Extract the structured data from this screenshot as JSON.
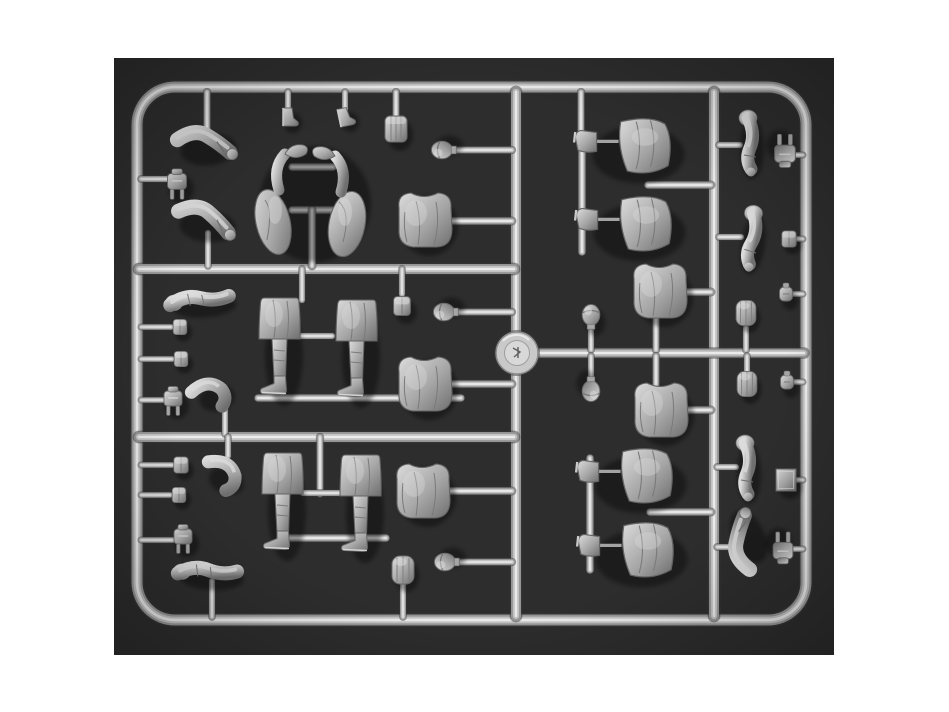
{
  "scene": {
    "type": "photograph",
    "subject": "plastic-model-kit-sprue-with-soldier-figure-parts",
    "canvas": {
      "width": 949,
      "height": 712
    },
    "photo": {
      "x": 114,
      "y": 58,
      "width": 720,
      "height": 597
    },
    "colors": {
      "page_bg": "#ffffff",
      "photo_bg": "#2d2d2d",
      "tube_dark": "#3a3a3a",
      "tube_base": "#959595",
      "tube_mid": "#c2c2c2",
      "tube_highlight": "#efefef",
      "part_base": "#a6a6a6",
      "part_light": "#dcdcdc",
      "part_shadow": "#6f6f6f",
      "part_outline": "#646464",
      "hub_fill": "#c9c9c9",
      "hub_inner": "#d8d8d8"
    }
  },
  "sprue": {
    "frame": {
      "x": 137,
      "y": 87,
      "width": 669,
      "height": 533,
      "radius": 38,
      "tube_width": 11
    },
    "hub": {
      "cx": 517,
      "cy": 353,
      "r": 21,
      "inner_r": 12.5
    },
    "runners": [
      [
        516,
        92,
        516,
        616,
        10
      ],
      [
        714,
        92,
        714,
        616,
        10
      ],
      [
        139,
        269,
        514,
        269,
        10
      ],
      [
        139,
        437,
        514,
        437,
        10
      ],
      [
        536,
        353,
        804,
        353,
        9
      ]
    ],
    "stubs": [
      [
        207,
        92,
        207,
        130,
        6.5
      ],
      [
        288,
        92,
        288,
        109,
        6
      ],
      [
        345,
        92,
        345,
        109,
        6
      ],
      [
        396,
        92,
        396,
        116,
        6.5
      ],
      [
        581,
        92,
        581,
        140,
        6.5
      ],
      [
        141,
        179,
        168,
        179,
        6
      ],
      [
        141,
        327,
        171,
        327,
        5.5
      ],
      [
        141,
        359,
        172,
        359,
        5.5
      ],
      [
        141,
        400,
        163,
        400,
        5.5
      ],
      [
        141,
        465,
        172,
        465,
        5.5
      ],
      [
        141,
        495,
        170,
        495,
        5.5
      ],
      [
        141,
        540,
        173,
        540,
        5.5
      ],
      [
        452,
        150,
        512,
        150,
        6.5
      ],
      [
        450,
        221,
        512,
        221,
        7
      ],
      [
        455,
        312,
        512,
        312,
        6.5
      ],
      [
        450,
        384,
        512,
        384,
        7
      ],
      [
        450,
        491,
        512,
        491,
        7
      ],
      [
        455,
        562,
        512,
        562,
        6.5
      ],
      [
        292,
        167,
        333,
        167,
        7
      ],
      [
        292,
        210,
        333,
        210,
        7
      ],
      [
        312,
        210,
        312,
        266,
        7
      ],
      [
        297,
        336,
        332,
        336,
        6
      ],
      [
        302,
        269,
        302,
        300,
        6
      ],
      [
        402,
        269,
        402,
        294,
        6
      ],
      [
        258,
        398,
        461,
        398,
        7
      ],
      [
        208,
        233,
        208,
        266,
        6
      ],
      [
        320,
        437,
        320,
        494,
        6.5
      ],
      [
        303,
        493,
        340,
        493,
        6
      ],
      [
        289,
        538,
        386,
        538,
        7
      ],
      [
        225,
        408,
        225,
        434,
        6
      ],
      [
        228,
        437,
        228,
        456,
        6
      ],
      [
        212,
        581,
        212,
        617,
        6
      ],
      [
        403,
        584,
        403,
        617,
        6
      ],
      [
        582,
        135,
        582,
        252,
        7
      ],
      [
        648,
        185,
        711,
        185,
        7
      ],
      [
        719,
        145,
        740,
        145,
        6
      ],
      [
        719,
        237,
        741,
        237,
        6
      ],
      [
        686,
        292,
        711,
        292,
        7
      ],
      [
        656,
        313,
        656,
        350,
        6.5
      ],
      [
        656,
        356,
        656,
        386,
        6.5
      ],
      [
        687,
        410,
        711,
        410,
        7
      ],
      [
        746,
        328,
        746,
        350,
        6
      ],
      [
        747,
        356,
        747,
        371,
        6
      ],
      [
        591,
        326,
        591,
        350,
        6
      ],
      [
        591,
        356,
        591,
        380,
        6
      ],
      [
        793,
        155,
        803,
        155,
        5.5
      ],
      [
        795,
        239,
        803,
        239,
        5.5
      ],
      [
        794,
        294,
        803,
        294,
        5.5
      ],
      [
        795,
        382,
        803,
        382,
        5.5
      ],
      [
        590,
        458,
        590,
        570,
        7
      ],
      [
        650,
        512,
        711,
        512,
        7
      ],
      [
        717,
        467,
        736,
        467,
        6
      ],
      [
        717,
        547,
        736,
        547,
        6
      ],
      [
        795,
        480,
        803,
        480,
        5.5
      ],
      [
        793,
        549,
        803,
        549,
        5.5
      ]
    ],
    "parts": [
      {
        "type": "flask-prongs",
        "x": 177,
        "y": 183,
        "s": 1.05
      },
      {
        "type": "pouch",
        "x": 180,
        "y": 327,
        "s": 0.85
      },
      {
        "type": "pouch",
        "x": 181,
        "y": 359,
        "s": 0.85
      },
      {
        "type": "flask-prongs",
        "x": 173,
        "y": 400
      },
      {
        "type": "pouch",
        "x": 181,
        "y": 465,
        "s": 0.9
      },
      {
        "type": "pouch",
        "x": 179,
        "y": 495,
        "s": 0.85
      },
      {
        "type": "flask-prongs",
        "x": 183,
        "y": 538
      },
      {
        "type": "bent-arm",
        "x": 204,
        "y": 144,
        "r": -6
      },
      {
        "type": "bent-arm",
        "x": 204,
        "y": 220,
        "r": 4
      },
      {
        "type": "straight-arm",
        "x": 200,
        "y": 300,
        "r": -4
      },
      {
        "type": "bent-knee",
        "x": 212,
        "y": 393,
        "r": -12
      },
      {
        "type": "bent-knee",
        "x": 225,
        "y": 474,
        "r": 22
      },
      {
        "type": "straight-arm",
        "x": 208,
        "y": 572,
        "r": 3
      },
      {
        "type": "boot-small",
        "x": 289,
        "y": 117
      },
      {
        "type": "boot-small",
        "x": 345,
        "y": 117,
        "r": -12
      },
      {
        "type": "backpack",
        "x": 396,
        "y": 129
      },
      {
        "type": "legs-lambda",
        "x": 311,
        "y": 198
      },
      {
        "type": "torso",
        "x": 425,
        "y": 220
      },
      {
        "type": "head",
        "x": 443,
        "y": 150,
        "r": -90,
        "s": 1.1
      },
      {
        "type": "leg-standing",
        "x": 280,
        "y": 350
      },
      {
        "type": "leg-standing",
        "x": 357,
        "y": 352
      },
      {
        "type": "pouch",
        "x": 402,
        "y": 306,
        "s": 1.05
      },
      {
        "type": "head",
        "x": 445,
        "y": 312,
        "r": -90,
        "s": 1.1
      },
      {
        "type": "torso",
        "x": 425,
        "y": 384
      },
      {
        "type": "leg-standing",
        "x": 283,
        "y": 505
      },
      {
        "type": "leg-standing",
        "x": 361,
        "y": 507
      },
      {
        "type": "torso",
        "x": 423,
        "y": 491
      },
      {
        "type": "head",
        "x": 446,
        "y": 562,
        "r": -90,
        "s": 1.1
      },
      {
        "type": "canteen",
        "x": 403,
        "y": 570
      },
      {
        "type": "leg-horizontal",
        "x": 634,
        "y": 148,
        "s": 1.1
      },
      {
        "type": "leg-horizontal",
        "x": 635,
        "y": 226,
        "s": 1.1
      },
      {
        "type": "arm-vert",
        "x": 748,
        "y": 143
      },
      {
        "type": "arm-vert",
        "x": 750,
        "y": 238,
        "r": 8
      },
      {
        "type": "flask-prongs",
        "x": 785,
        "y": 152,
        "r": 180,
        "s": 1.15
      },
      {
        "type": "pouch",
        "x": 789,
        "y": 239,
        "s": 0.9
      },
      {
        "type": "torso",
        "x": 660,
        "y": 291
      },
      {
        "type": "torso",
        "x": 661,
        "y": 410
      },
      {
        "type": "canteen",
        "x": 746,
        "y": 313,
        "s": 0.9
      },
      {
        "type": "canteen",
        "x": 747,
        "y": 384,
        "s": 0.9
      },
      {
        "type": "grenade",
        "x": 786,
        "y": 294
      },
      {
        "type": "grenade",
        "x": 787,
        "y": 382
      },
      {
        "type": "head",
        "x": 591,
        "y": 316,
        "s": 1.1
      },
      {
        "type": "head",
        "x": 591,
        "y": 390,
        "r": 180,
        "s": 1.1
      },
      {
        "type": "leg-horizontal",
        "x": 636,
        "y": 478,
        "s": 1.1
      },
      {
        "type": "leg-horizontal",
        "x": 637,
        "y": 552,
        "s": 1.1
      },
      {
        "type": "arm-vert",
        "x": 745,
        "y": 468
      },
      {
        "type": "bent-arm",
        "x": 745,
        "y": 543,
        "r": -115
      },
      {
        "type": "flat-plate",
        "x": 786,
        "y": 480
      },
      {
        "type": "flask-prongs",
        "x": 783,
        "y": 549,
        "r": 180,
        "s": 1.1
      }
    ]
  }
}
